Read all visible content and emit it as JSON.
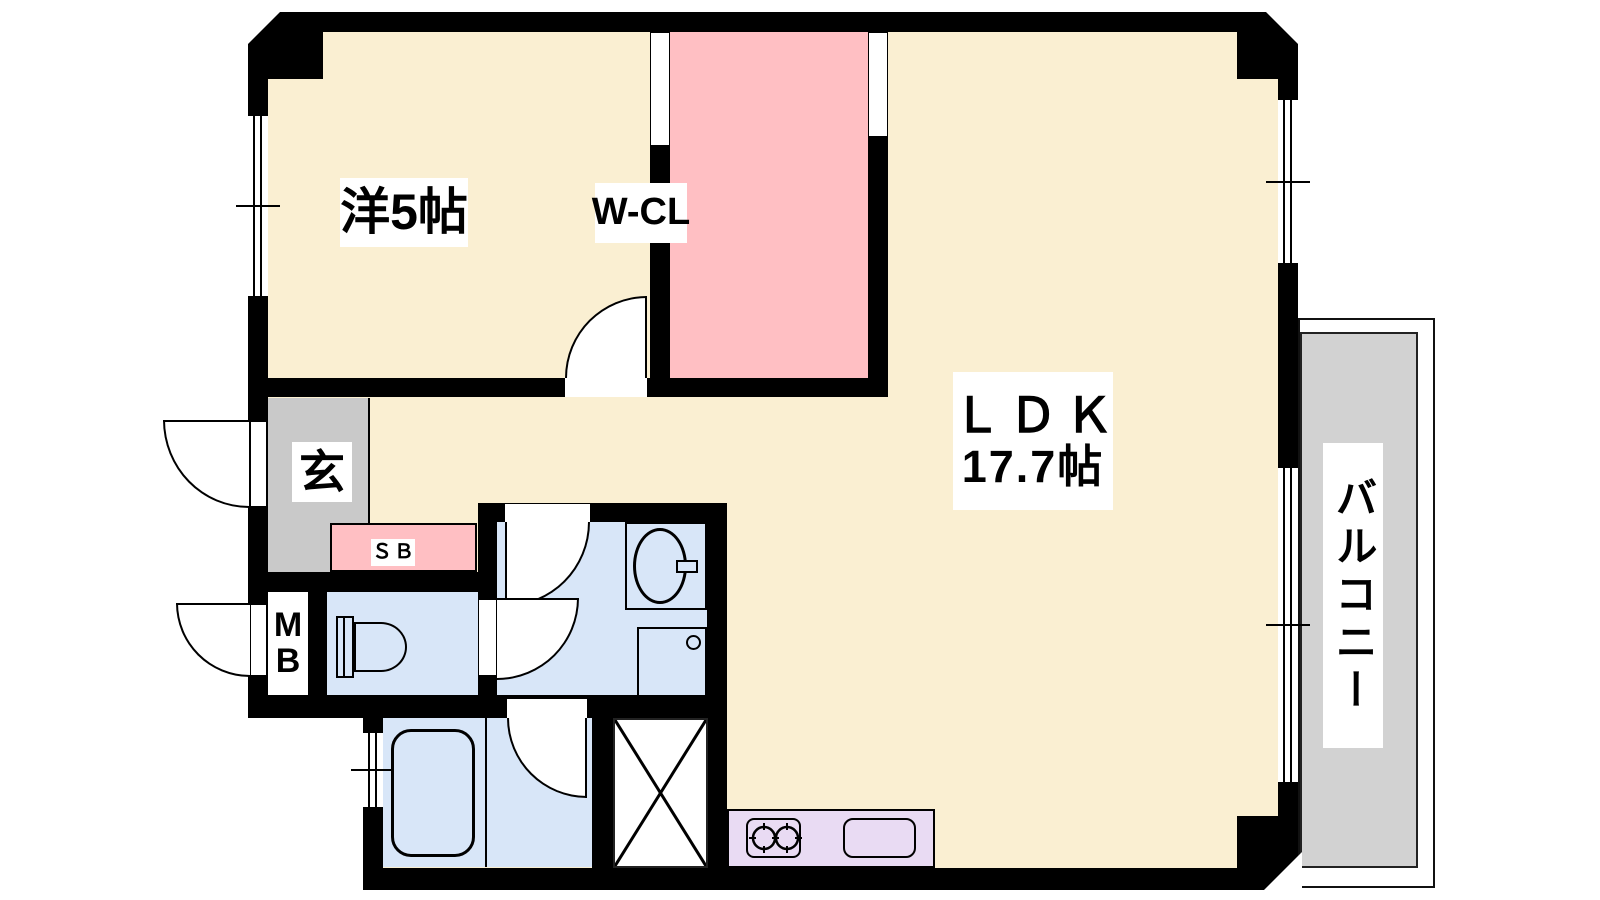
{
  "plan_title": "1LDK apartment floor plan",
  "palette": {
    "cream": "#FAEFD2",
    "pink": "#FFBFC3",
    "gray": "#C9C9C9",
    "blue": "#D8E6F8",
    "lavender": "#E9DBF3",
    "balcony_gray": "#D2D2D2",
    "wall": "#000000"
  },
  "rooms": {
    "western": {
      "label": "洋5帖"
    },
    "wcl": {
      "label": "W-CL"
    },
    "ldk": {
      "name": "ＬＤＫ",
      "size": "17.7帖"
    },
    "genkan": {
      "label": "玄"
    },
    "sb": {
      "label": "ＳＢ"
    },
    "mb": {
      "line1": "M",
      "line2": "B"
    },
    "balcony": {
      "label": "バルコニー"
    }
  },
  "fixtures": [
    "toilet",
    "washbasin",
    "washing-machine-pan",
    "bathtub",
    "pipe-space-x",
    "gas-stove-2-burner",
    "kitchen-sink"
  ],
  "openings": {
    "windows": 4,
    "hinged_doors": 6,
    "entrance_side": "left"
  }
}
